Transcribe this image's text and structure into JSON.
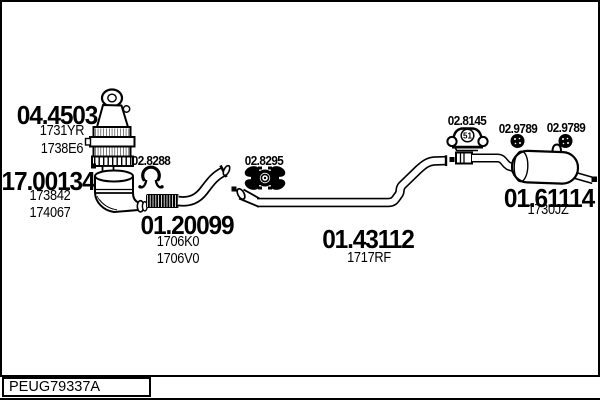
{
  "reference": "PEUG79337A",
  "colors": {
    "line": "#000000",
    "background": "#ffffff"
  },
  "parts": [
    {
      "number": "04.4503",
      "codes": [
        "1731YR",
        "1738E6"
      ]
    },
    {
      "number": "17.00134",
      "codes": [
        "173842",
        "174067"
      ]
    },
    {
      "number": "01.20099",
      "codes": [
        "1706K0",
        "1706V0"
      ]
    },
    {
      "number": "01.43112",
      "codes": [
        "1717RF"
      ]
    },
    {
      "number": "01.61114",
      "codes": [
        "1730JZ"
      ]
    }
  ],
  "fittings": [
    {
      "number": "02.8288",
      "icon": "clamp-icon"
    },
    {
      "number": "02.8295",
      "icon": "rubber-mount-icon"
    },
    {
      "number": "02.8145",
      "icon": "hanger-bracket-icon",
      "badge": "51"
    },
    {
      "number": "02.9789",
      "icon": "grommet-icon"
    },
    {
      "number": "02.9789",
      "icon": "grommet-icon"
    }
  ]
}
